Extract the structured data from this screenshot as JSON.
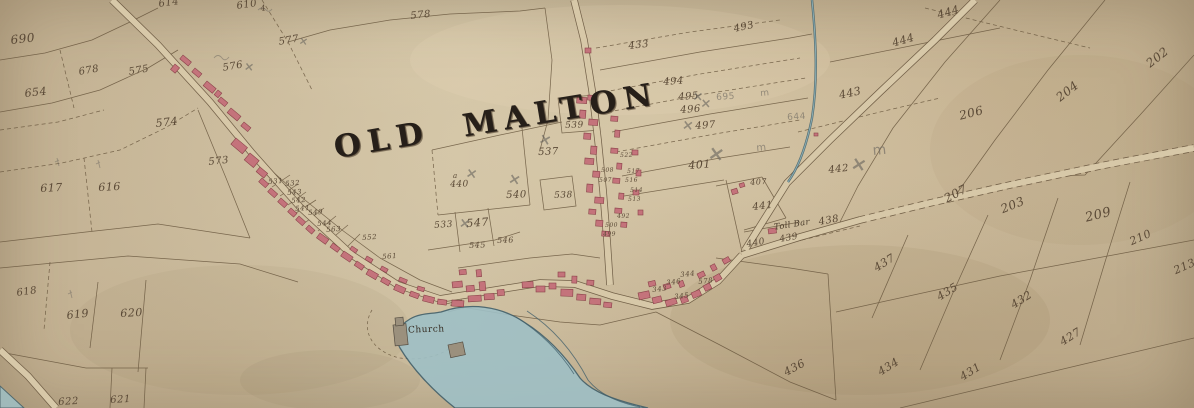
{
  "map": {
    "title": "OLD MALTON",
    "church_label": "Church",
    "toll_bar_label": "Toll Bar",
    "colors": {
      "paper": "#c8b798",
      "ink_lines": "#6a583f",
      "ink_text": "#5a4936",
      "building_red": "#c4737b",
      "building_red_dark": "#8a4249",
      "building_gray": "#9b907d",
      "water_fill": "#9fc0c6",
      "water_line": "#42606b",
      "pencil": "#6b665f",
      "title_ink": "#261f19"
    },
    "parcels": [
      {
        "t": "690",
        "x": 10,
        "y": 34,
        "s": 12,
        "r": -6,
        "k": "ink"
      },
      {
        "t": "654",
        "x": 24,
        "y": 88,
        "s": 11,
        "r": -6,
        "k": "ink"
      },
      {
        "t": "678",
        "x": 78,
        "y": 68,
        "s": 10,
        "r": -10,
        "k": "ink"
      },
      {
        "t": "575",
        "x": 128,
        "y": 68,
        "s": 10,
        "r": -10,
        "k": "ink"
      },
      {
        "t": "574",
        "x": 155,
        "y": 118,
        "s": 11,
        "r": -6,
        "k": "ink"
      },
      {
        "t": "617",
        "x": 40,
        "y": 183,
        "s": 11,
        "r": -3,
        "k": "ink"
      },
      {
        "t": "616",
        "x": 98,
        "y": 182,
        "s": 11,
        "r": -3,
        "k": "ink"
      },
      {
        "t": "618",
        "x": 16,
        "y": 289,
        "s": 10,
        "r": -8,
        "k": "ink"
      },
      {
        "t": "619",
        "x": 66,
        "y": 310,
        "s": 11,
        "r": -6,
        "k": "ink"
      },
      {
        "t": "620",
        "x": 120,
        "y": 308,
        "s": 11,
        "r": -3,
        "k": "ink"
      },
      {
        "t": "622",
        "x": 58,
        "y": 398,
        "s": 10,
        "r": -3,
        "k": "ink"
      },
      {
        "t": "621",
        "x": 110,
        "y": 396,
        "s": 10,
        "r": -3,
        "k": "ink"
      },
      {
        "t": "614",
        "x": 158,
        "y": 0,
        "s": 10,
        "r": -8,
        "k": "ink"
      },
      {
        "t": "610",
        "x": 236,
        "y": 2,
        "s": 10,
        "r": -8,
        "k": "ink"
      },
      {
        "t": "4",
        "x": 260,
        "y": 5,
        "s": 8,
        "r": -8,
        "k": "ink"
      },
      {
        "t": "578",
        "x": 410,
        "y": 12,
        "s": 10,
        "r": -6,
        "k": "ink"
      },
      {
        "t": "577",
        "x": 278,
        "y": 38,
        "s": 10,
        "r": -10,
        "k": "ink"
      },
      {
        "t": "576",
        "x": 222,
        "y": 64,
        "s": 10,
        "r": -10,
        "k": "ink"
      },
      {
        "t": "573",
        "x": 208,
        "y": 158,
        "s": 10,
        "r": -6,
        "k": "ink"
      },
      {
        "t": "433",
        "x": 628,
        "y": 42,
        "s": 10,
        "r": -6,
        "k": "ink"
      },
      {
        "t": "493",
        "x": 733,
        "y": 25,
        "s": 10,
        "r": -12,
        "k": "ink"
      },
      {
        "t": "443",
        "x": 838,
        "y": 90,
        "s": 11,
        "r": -12,
        "k": "ink"
      },
      {
        "t": "444",
        "x": 891,
        "y": 38,
        "s": 11,
        "r": -16,
        "k": "ink"
      },
      {
        "t": "444",
        "x": 936,
        "y": 10,
        "s": 11,
        "r": -16,
        "k": "ink"
      },
      {
        "t": "442",
        "x": 828,
        "y": 166,
        "s": 10,
        "r": -6,
        "k": "ink"
      },
      {
        "t": "494",
        "x": 663,
        "y": 78,
        "s": 10,
        "r": -4,
        "k": "ink"
      },
      {
        "t": "495",
        "x": 678,
        "y": 93,
        "s": 10,
        "r": -4,
        "k": "ink"
      },
      {
        "t": "496",
        "x": 680,
        "y": 106,
        "s": 10,
        "r": -4,
        "k": "ink"
      },
      {
        "t": "497",
        "x": 695,
        "y": 122,
        "s": 10,
        "r": -4,
        "k": "ink"
      },
      {
        "t": "401",
        "x": 688,
        "y": 160,
        "s": 11,
        "r": -4,
        "k": "ink"
      },
      {
        "t": "407",
        "x": 750,
        "y": 179,
        "s": 8,
        "r": -4,
        "k": "ink"
      },
      {
        "t": "441",
        "x": 752,
        "y": 203,
        "s": 10,
        "r": -6,
        "k": "ink"
      },
      {
        "t": "440",
        "x": 746,
        "y": 241,
        "s": 9,
        "r": -10,
        "k": "ink"
      },
      {
        "t": "439",
        "x": 779,
        "y": 236,
        "s": 9,
        "r": -10,
        "k": "ink"
      },
      {
        "t": "438",
        "x": 818,
        "y": 218,
        "s": 10,
        "r": -10,
        "k": "ink"
      },
      {
        "t": "539",
        "x": 565,
        "y": 122,
        "s": 9,
        "r": -2,
        "k": "ink"
      },
      {
        "t": "537",
        "x": 538,
        "y": 148,
        "s": 10,
        "r": -2,
        "k": "ink"
      },
      {
        "t": "540",
        "x": 506,
        "y": 191,
        "s": 10,
        "r": -2,
        "k": "ink"
      },
      {
        "t": "538",
        "x": 554,
        "y": 192,
        "s": 9,
        "r": -2,
        "k": "ink"
      },
      {
        "t": "547",
        "x": 466,
        "y": 218,
        "s": 11,
        "r": -4,
        "k": "ink"
      },
      {
        "t": "533",
        "x": 434,
        "y": 222,
        "s": 9,
        "r": -4,
        "k": "ink"
      },
      {
        "t": "545",
        "x": 469,
        "y": 242,
        "s": 8,
        "r": -2,
        "k": "ink"
      },
      {
        "t": "546",
        "x": 497,
        "y": 237,
        "s": 8,
        "r": -2,
        "k": "ink"
      },
      {
        "t": "440",
        "x": 450,
        "y": 181,
        "s": 9,
        "r": -2,
        "k": "ink"
      },
      {
        "t": "a",
        "x": 453,
        "y": 173,
        "s": 7,
        "r": 0,
        "k": "ink"
      },
      {
        "t": "531",
        "x": 268,
        "y": 179,
        "s": 7,
        "r": -4,
        "k": "ink"
      },
      {
        "t": "532",
        "x": 285,
        "y": 181,
        "s": 7,
        "r": -4,
        "k": "ink"
      },
      {
        "t": "543",
        "x": 287,
        "y": 190,
        "s": 7,
        "r": -4,
        "k": "ink"
      },
      {
        "t": "542",
        "x": 291,
        "y": 198,
        "s": 7,
        "r": -4,
        "k": "ink"
      },
      {
        "t": "541",
        "x": 295,
        "y": 206,
        "s": 7,
        "r": -4,
        "k": "ink"
      },
      {
        "t": "549",
        "x": 308,
        "y": 210,
        "s": 7,
        "r": -4,
        "k": "ink"
      },
      {
        "t": "544",
        "x": 317,
        "y": 221,
        "s": 7,
        "r": -4,
        "k": "ink"
      },
      {
        "t": "563",
        "x": 326,
        "y": 227,
        "s": 7,
        "r": -4,
        "k": "ink"
      },
      {
        "t": "552",
        "x": 362,
        "y": 235,
        "s": 7,
        "r": -4,
        "k": "ink"
      },
      {
        "t": "561",
        "x": 382,
        "y": 254,
        "s": 7,
        "r": -4,
        "k": "ink"
      },
      {
        "t": "522",
        "x": 620,
        "y": 153,
        "s": 6,
        "r": -2,
        "k": "ink"
      },
      {
        "t": "517",
        "x": 627,
        "y": 169,
        "s": 6,
        "r": -2,
        "k": "ink"
      },
      {
        "t": "516",
        "x": 625,
        "y": 178,
        "s": 6,
        "r": -2,
        "k": "ink"
      },
      {
        "t": "514",
        "x": 630,
        "y": 188,
        "s": 6,
        "r": -2,
        "k": "ink"
      },
      {
        "t": "513",
        "x": 628,
        "y": 197,
        "s": 6,
        "r": -2,
        "k": "ink"
      },
      {
        "t": "508",
        "x": 601,
        "y": 168,
        "s": 6,
        "r": -2,
        "k": "ink"
      },
      {
        "t": "507",
        "x": 599,
        "y": 178,
        "s": 6,
        "r": -2,
        "k": "ink"
      },
      {
        "t": "500",
        "x": 605,
        "y": 223,
        "s": 6,
        "r": -2,
        "k": "ink"
      },
      {
        "t": "499",
        "x": 603,
        "y": 232,
        "s": 6,
        "r": -2,
        "k": "ink"
      },
      {
        "t": "492",
        "x": 617,
        "y": 214,
        "s": 6,
        "r": -2,
        "k": "ink"
      },
      {
        "t": "344",
        "x": 680,
        "y": 272,
        "s": 7,
        "r": -6,
        "k": "ink"
      },
      {
        "t": "578",
        "x": 698,
        "y": 279,
        "s": 7,
        "r": -6,
        "k": "ink"
      },
      {
        "t": "346",
        "x": 666,
        "y": 280,
        "s": 7,
        "r": -6,
        "k": "ink"
      },
      {
        "t": "345",
        "x": 674,
        "y": 294,
        "s": 7,
        "r": -6,
        "k": "ink"
      },
      {
        "t": "343",
        "x": 652,
        "y": 287,
        "s": 7,
        "r": -6,
        "k": "ink"
      },
      {
        "t": "207",
        "x": 942,
        "y": 194,
        "s": 12,
        "r": -28,
        "k": "ink"
      },
      {
        "t": "203",
        "x": 999,
        "y": 204,
        "s": 12,
        "r": -22,
        "k": "ink"
      },
      {
        "t": "209",
        "x": 1084,
        "y": 212,
        "s": 13,
        "r": -14,
        "k": "ink"
      },
      {
        "t": "210",
        "x": 1128,
        "y": 237,
        "s": 11,
        "r": -24,
        "k": "ink"
      },
      {
        "t": "213",
        "x": 1172,
        "y": 266,
        "s": 11,
        "r": -24,
        "k": "ink"
      },
      {
        "t": "202",
        "x": 1144,
        "y": 60,
        "s": 12,
        "r": -38,
        "k": "ink"
      },
      {
        "t": "204",
        "x": 1054,
        "y": 94,
        "s": 12,
        "r": -38,
        "k": "ink"
      },
      {
        "t": "206",
        "x": 958,
        "y": 110,
        "s": 12,
        "r": -14,
        "k": "ink"
      },
      {
        "t": "437",
        "x": 872,
        "y": 264,
        "s": 11,
        "r": -32,
        "k": "ink"
      },
      {
        "t": "435",
        "x": 935,
        "y": 293,
        "s": 11,
        "r": -32,
        "k": "ink"
      },
      {
        "t": "432",
        "x": 1009,
        "y": 301,
        "s": 11,
        "r": -32,
        "k": "ink"
      },
      {
        "t": "427",
        "x": 1058,
        "y": 338,
        "s": 11,
        "r": -32,
        "k": "ink"
      },
      {
        "t": "434",
        "x": 876,
        "y": 368,
        "s": 11,
        "r": -32,
        "k": "ink"
      },
      {
        "t": "431",
        "x": 958,
        "y": 373,
        "s": 11,
        "r": -32,
        "k": "ink"
      },
      {
        "t": "436",
        "x": 782,
        "y": 368,
        "s": 11,
        "r": -28,
        "k": "ink"
      },
      {
        "t": "695",
        "x": 716,
        "y": 94,
        "s": 9,
        "r": -4,
        "k": "pencil"
      },
      {
        "t": "644",
        "x": 787,
        "y": 114,
        "s": 9,
        "r": -4,
        "k": "pencil"
      },
      {
        "t": "×",
        "x": 245,
        "y": 60,
        "s": 12,
        "r": 8,
        "k": "penx"
      },
      {
        "t": "×",
        "x": 300,
        "y": 35,
        "s": 11,
        "r": 10,
        "k": "penx"
      },
      {
        "t": "×",
        "x": 541,
        "y": 131,
        "s": 15,
        "r": 15,
        "k": "penx"
      },
      {
        "t": "×",
        "x": 467,
        "y": 166,
        "s": 14,
        "r": 10,
        "k": "penx"
      },
      {
        "t": "×",
        "x": 510,
        "y": 171,
        "s": 15,
        "r": 12,
        "k": "penx"
      },
      {
        "t": "×",
        "x": 693,
        "y": 90,
        "s": 13,
        "r": 5,
        "k": "penx"
      },
      {
        "t": "×",
        "x": 701,
        "y": 97,
        "s": 13,
        "r": 5,
        "k": "penx"
      },
      {
        "t": "×",
        "x": 683,
        "y": 118,
        "s": 14,
        "r": 8,
        "k": "penx"
      },
      {
        "t": "×",
        "x": 710,
        "y": 142,
        "s": 20,
        "r": 10,
        "k": "penx"
      },
      {
        "t": "×",
        "x": 853,
        "y": 154,
        "s": 19,
        "r": 12,
        "k": "penx"
      },
      {
        "t": "×",
        "x": 460,
        "y": 216,
        "s": 14,
        "r": 8,
        "k": "penx"
      },
      {
        "t": "m",
        "x": 872,
        "y": 144,
        "s": 14,
        "r": -5,
        "k": "pencil"
      },
      {
        "t": "m",
        "x": 756,
        "y": 144,
        "s": 10,
        "r": -5,
        "k": "pencil"
      },
      {
        "t": "m",
        "x": 760,
        "y": 90,
        "s": 9,
        "r": -5,
        "k": "pencil"
      }
    ]
  }
}
